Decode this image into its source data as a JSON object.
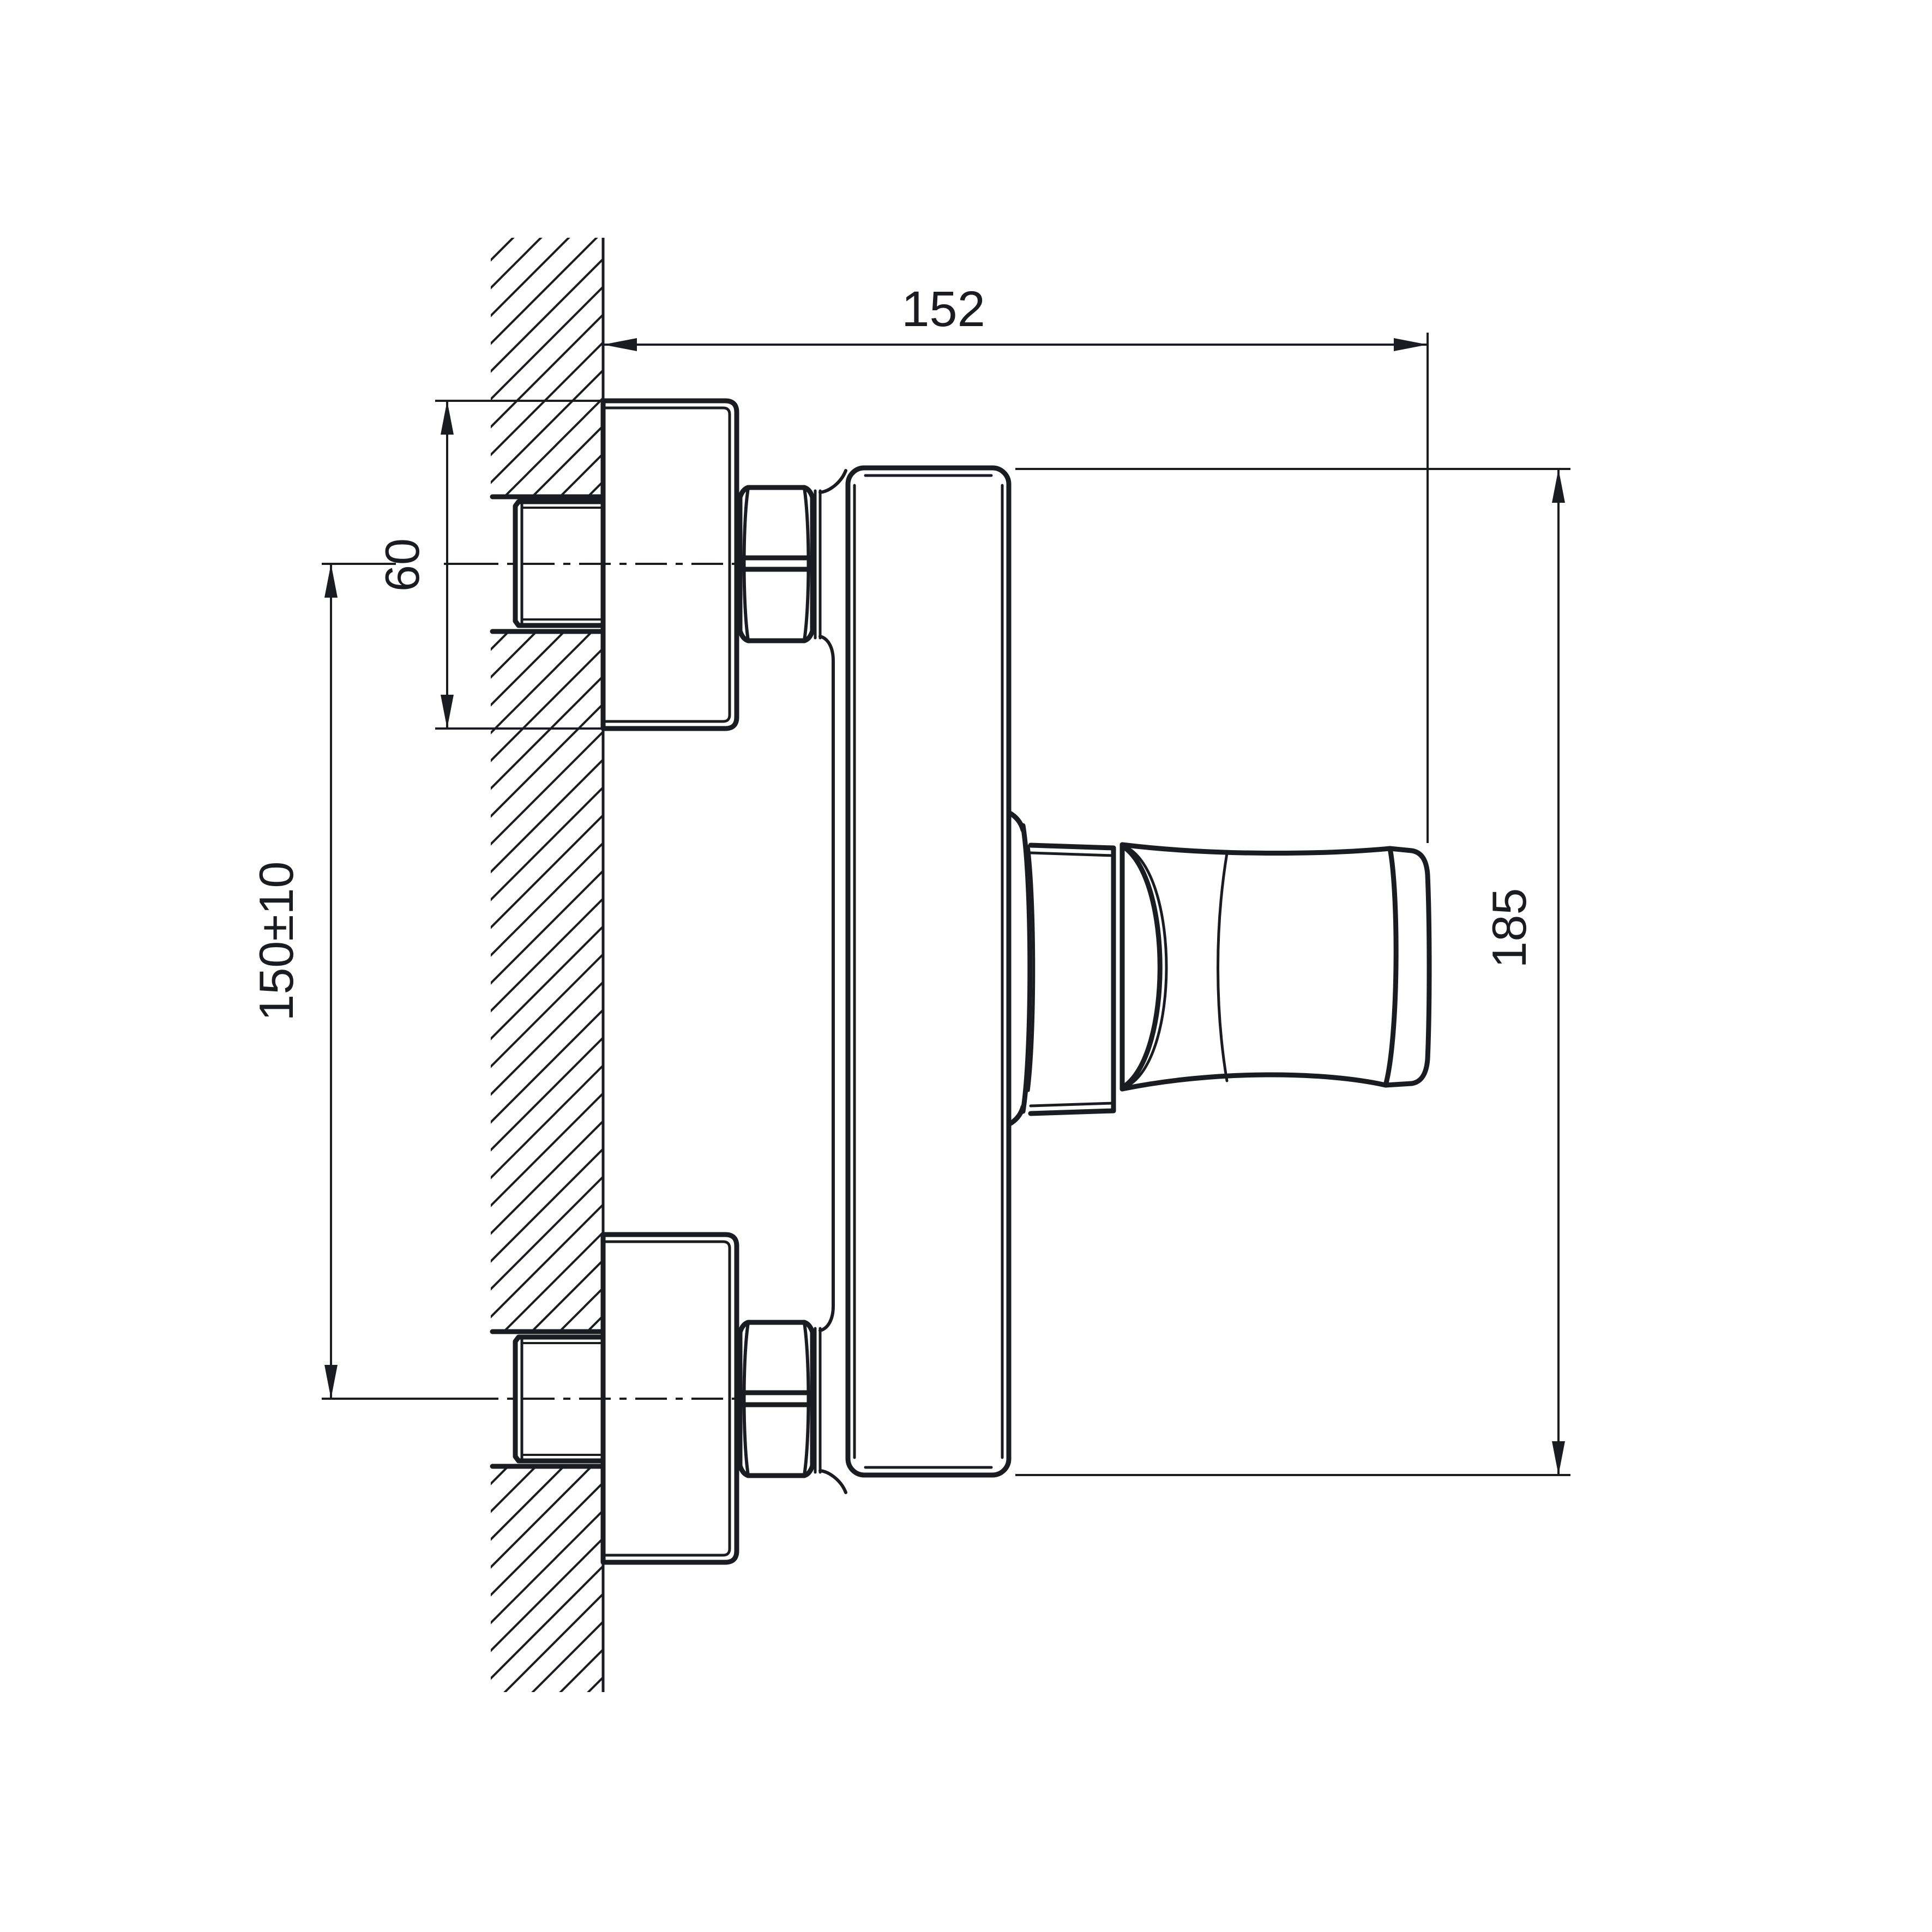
{
  "page": {
    "background": "#ffffff"
  },
  "drawing": {
    "line_color": "#1b1b22",
    "dimensions": {
      "mounting_depth": {
        "label": "152"
      },
      "escutcheon_diameter": {
        "label": "60"
      },
      "connection_centers": {
        "label": "150±10"
      },
      "body_height": {
        "label": "185"
      }
    }
  }
}
